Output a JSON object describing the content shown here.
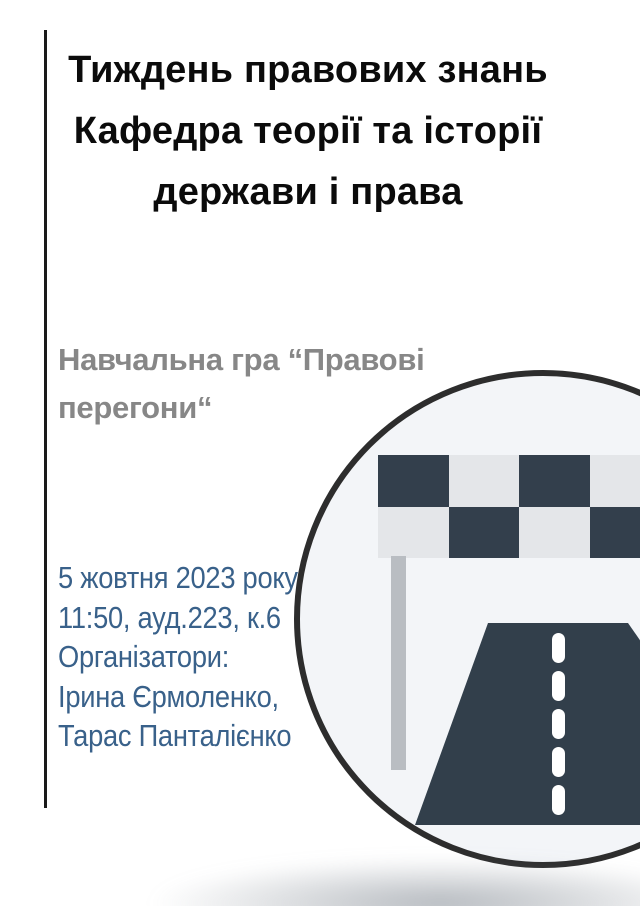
{
  "title": {
    "line1": "Тиждень правових знань",
    "line2": "Кафедра теорії та історії",
    "line3": "держави і права"
  },
  "subtitle": {
    "lines": [
      "Навчальна гра “Правові",
      "перегони“"
    ]
  },
  "details": {
    "lines": [
      "5 жовтня 2023 року",
      "11:50, ауд.223, к.6",
      "Організатори:",
      "Ірина Єрмоленко,",
      "Тарас Панталієнко"
    ]
  },
  "illustration": {
    "icons": [
      "checkered-flag-icon",
      "flag-pole-icon",
      "road-icon",
      "road-center-line-icon"
    ],
    "description_free_shapes": "circle badge with racing finish flag and road"
  },
  "colors": {
    "background": "#ffffff",
    "title_text": "#0b0b0b",
    "subtitle_text": "#878787",
    "details_text": "#39618a",
    "left_rule": "#1a1a1a",
    "circle_fill": "#f3f5f8",
    "circle_stroke": "#2d2d2d",
    "flag_dark": "#333f4c",
    "flag_light": "#e4e6e9",
    "pole_gray": "#b9bdc2",
    "road_dark": "#323f4b",
    "road_dash": "#ffffff",
    "bottom_shadow": "#787f8a"
  }
}
